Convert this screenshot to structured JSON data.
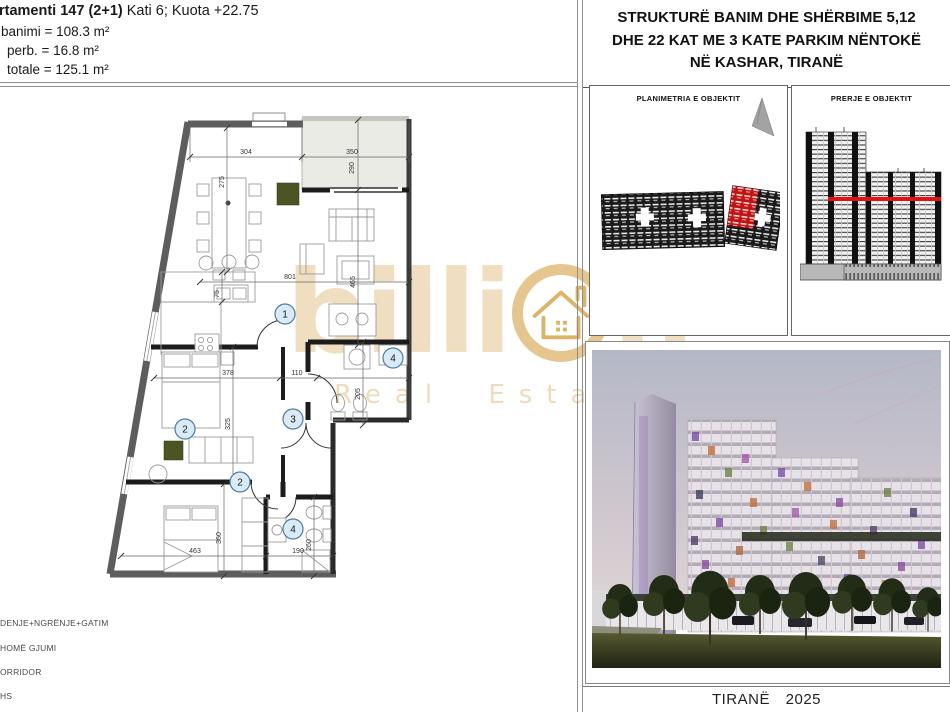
{
  "header": {
    "apartment_bold": "rtamenti 147 (2+1)",
    "apartment_rest": "Kati 6; Kuota +22.75",
    "area_banimi": "banimi = 108.3 m²",
    "area_perb": "perb. = 16.8 m²",
    "area_totale": "totale = 125.1 m²"
  },
  "project_title": {
    "line1": "STRUKTURË BANIM DHE SHËRBIME 5,12",
    "line2": "DHE 22 KAT ME 3 KATE PARKIM NËNTOKË",
    "line3": "NË KASHAR, TIRANË"
  },
  "panels": {
    "planimetria_title": "PLANIMETRIA E OBJEKTIT",
    "prerje_title": "PRERJE E OBJEKTIT"
  },
  "footer": {
    "caption": "TIRANË 2025"
  },
  "legend": {
    "item1": "DENJE+NGRËNJE+GATIM",
    "item2": "HOMË GJUMI",
    "item3": "ORRIDOR",
    "item4": "HS"
  },
  "watermark": {
    "brand_pre": "billi",
    "brand_post": "n",
    "subtitle": "Real Estate",
    "gold_color": "#d9b26e"
  },
  "plan": {
    "rooms": {
      "living": "1",
      "bedroom_a": "2",
      "corridor": "3",
      "bath_a": "4",
      "bedroom_b": "2",
      "bath_b": "4"
    },
    "dims": {
      "dining_width": "304",
      "balcony_width": "350",
      "balcony_depth": "290",
      "table_len": "275",
      "living_width": "801",
      "counter_depth": "75",
      "living_depth": "465",
      "bedroom_a_width": "378",
      "hall_width": "110",
      "bath_a_depth": "205",
      "bedroom_a_depth": "325",
      "bedroom_b_width": "463",
      "bedroom_b_depth": "360",
      "bath_b_width": "190",
      "bath_b_depth": "260"
    },
    "colors": {
      "exterior_wall": "#5d5d5d",
      "interior_wall": "#1c1c1c",
      "balcony_fill": "#e9ebe4",
      "accent_green": "#4b5524",
      "badge_fill": "#d8ebf6",
      "badge_stroke": "#4d7d9c"
    }
  },
  "site_plan": {
    "highlight_red": "#c21212"
  },
  "section": {
    "cut_line_red": "#e01212"
  }
}
